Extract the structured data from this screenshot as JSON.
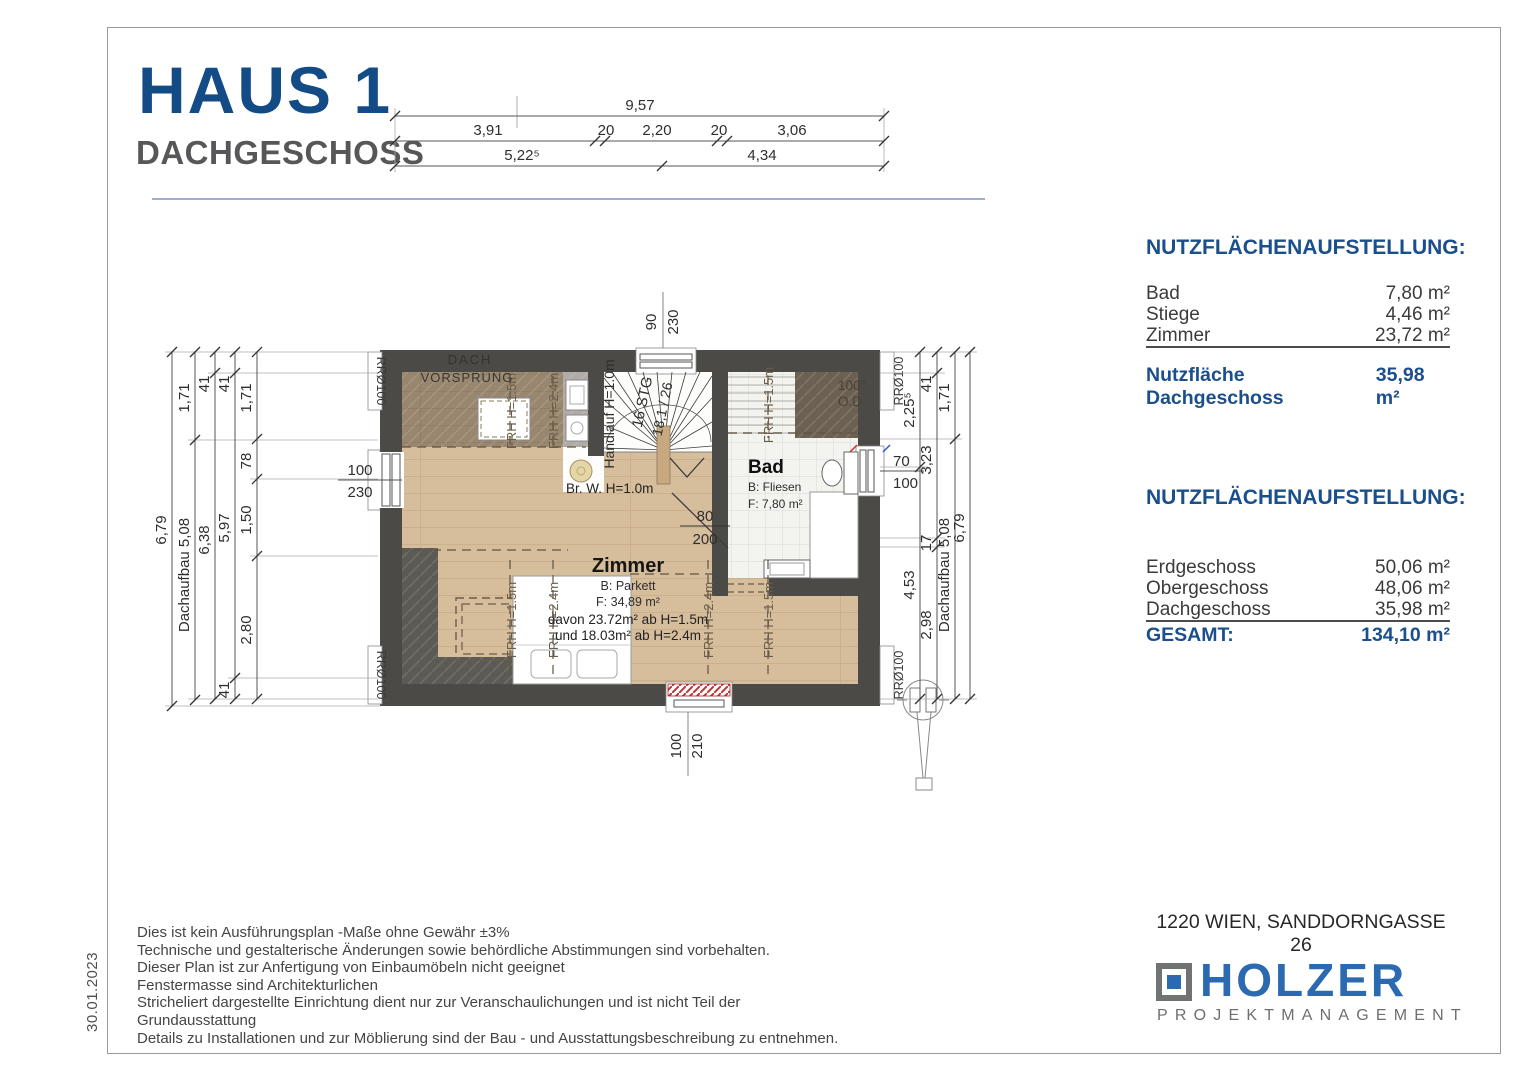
{
  "colors": {
    "title_blue": "#134b86",
    "heading_blue": "#1a4f8c",
    "holzer_blue": "#2b69b1",
    "gray_title": "#57575a",
    "wall": "#4b4a46",
    "wood": "#d6bd9c"
  },
  "title": {
    "main": "HAUS 1",
    "sub": "DACHGESCHOSS"
  },
  "date": "30.01.2023",
  "dims": {
    "top_total": "9,57",
    "top_a": "3,91",
    "top_b": "20",
    "top_c": "2,20",
    "top_d": "20",
    "top_e": "3,06",
    "top_f": "5,22⁵",
    "top_g": "4,34",
    "left_total": "6,79",
    "left_a": "1,71",
    "left_dach": "Dachaufbau 5,08",
    "left_b": "41",
    "left_c": "6,38",
    "left_d": "41",
    "left_e": "5,97",
    "left_f": "41",
    "left_g": "1,71",
    "left_h": "78",
    "left_i": "1,50",
    "left_j": "2,80",
    "right_a": "2,25⁵",
    "right_b": "4,53",
    "right_c": "41",
    "right_d": "3,23",
    "right_e": "17",
    "right_f": "2,98",
    "right_g": "1,71",
    "right_dach": "Dachaufbau 5,08",
    "right_total": "6,79"
  },
  "plan": {
    "roof_label_1": "DACH",
    "roof_label_2": "VORSPRUNG",
    "deg": "100°",
    "od": "O.D.",
    "rr": "RRØ100",
    "frh15": "FRH H=1.5m",
    "frh24": "FRH H=2.4m",
    "stair_steps": "16 STG",
    "stair_ratio": "18,1 / 26",
    "handrail": "Handlauf H=1.0m",
    "parapet": "Br. W. H=1.0m",
    "door_w": "80",
    "door_h": "200",
    "win_left_w": "100",
    "win_left_h": "230",
    "win_top_w": "90",
    "win_top_h": "230",
    "win_right_w": "70",
    "win_right_h": "100",
    "win_bottom_w": "100",
    "win_bottom_h": "210",
    "zimmer": {
      "name": "Zimmer",
      "floor": "B: Parkett",
      "area": "F: 34,89 m²",
      "note1": "davon 23.72m² ab H=1.5m",
      "note2": "und 18.03m² ab H=2.4m"
    },
    "bad": {
      "name": "Bad",
      "floor": "B: Fliesen",
      "area": "F: 7,80 m²"
    }
  },
  "area_table_dg": {
    "heading": "NUTZFLÄCHENAUFSTELLUNG:",
    "rows": [
      {
        "label": "Bad",
        "value": "7,80 m²"
      },
      {
        "label": "Stiege",
        "value": "4,46 m²"
      },
      {
        "label": "Zimmer",
        "value": "23,72 m²"
      }
    ],
    "total_label": "Nutzfläche Dachgeschoss",
    "total_value": "35,98 m²"
  },
  "area_table_house": {
    "heading": "NUTZFLÄCHENAUFSTELLUNG:",
    "rows": [
      {
        "label": "Erdgeschoss",
        "value": "50,06 m²"
      },
      {
        "label": "Obergeschoss",
        "value": "48,06 m²"
      },
      {
        "label": "Dachgeschoss",
        "value": "35,98 m²"
      }
    ],
    "total_label": "GESAMT:",
    "total_value": "134,10 m²"
  },
  "disclaimer": [
    "Dies ist kein Ausführungsplan -Maße ohne Gewähr ±3%",
    "Technische und gestalterische Änderungen sowie behördliche Abstimmungen sind vorbehalten.",
    "Dieser Plan ist zur Anfertigung von Einbaumöbeln nicht geeignet",
    "Fenstermasse sind Architekturlichen",
    "Stricheliert dargestellte Einrichtung dient nur zur Veranschaulichungen und ist nicht Teil der",
    "Grundausstattung",
    "Details zu Installationen und zur Möblierung sind der Bau - und Ausstattungsbeschreibung zu entnehmen."
  ],
  "address": "1220 WIEN, SANDDORNGASSE 26",
  "logo": {
    "name": "HOLZER",
    "sub": "PROJEKTMANAGEMENT"
  }
}
